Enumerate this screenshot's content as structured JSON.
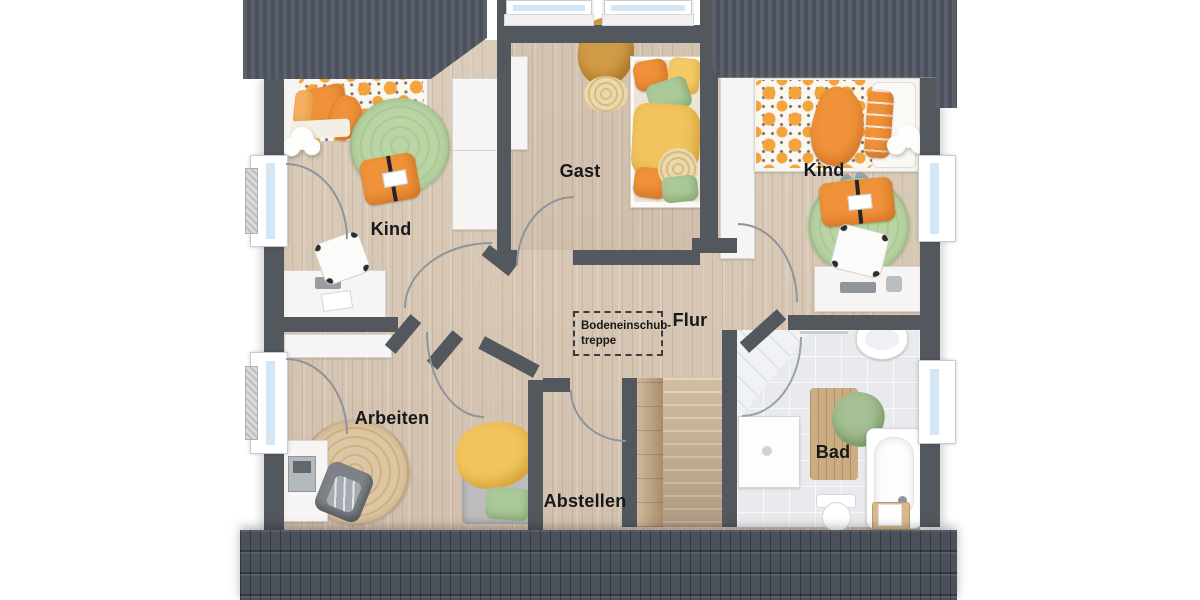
{
  "floorplan": {
    "title": "Dachgeschoss Grundriss",
    "labels": {
      "kind_left": "Kind",
      "gast": "Gast",
      "kind_right": "Kind",
      "arbeiten": "Arbeiten",
      "abstellen": "Abstellen",
      "flur": "Flur",
      "bad": "Bad",
      "loft_hatch_line1": "Bodeneinschub-",
      "loft_hatch_line2": "treppe"
    },
    "colors": {
      "roof": "#4e5560",
      "wall": "#53585f",
      "wood_floor": "#d6c6b4",
      "tile_floor": "#e8eaee",
      "accent_orange": "#f0923a",
      "accent_yellow": "#f5c966",
      "accent_green": "#abc898",
      "window_glass": "#d2e6f5",
      "label_text": "#17181a"
    }
  }
}
